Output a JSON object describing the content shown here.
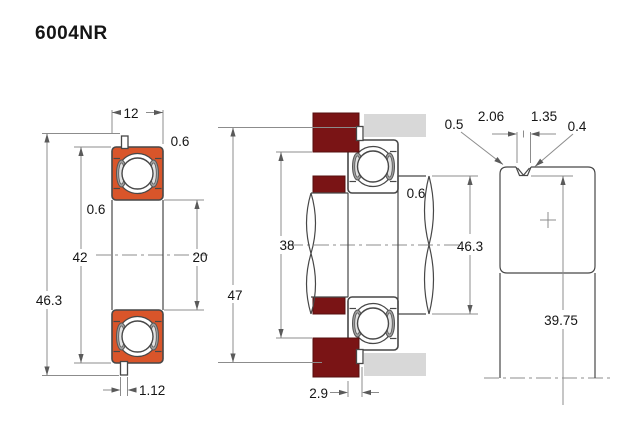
{
  "title": "6004NR",
  "colors": {
    "ring_fill": "#d9552a",
    "housing_dark": "#7a1415",
    "housing_light": "#d8d8d8",
    "outline": "#474747",
    "dimension_line": "#8c8c8c",
    "text": "#151515"
  },
  "front_view": {
    "width": "12",
    "outer_chamfer": "0.6",
    "inner_chamfer": "0.6",
    "outer_diameter": "42",
    "bore_diameter": "20",
    "snap_ring_diameter": "46.3",
    "tab_width": "1.12"
  },
  "mounted_view": {
    "shoulder_diameter": "38",
    "housing_bore_diameter": "47",
    "snap_ring_diameter": "46.3",
    "fillet_radius": "0.6",
    "groove_offset": "2.9"
  },
  "groove_detail": {
    "edge_margin": "0.5",
    "groove_width_top": "2.06",
    "groove_width_bottom": "1.35",
    "corner_radius": "0.4",
    "groove_diameter": "39.75"
  }
}
